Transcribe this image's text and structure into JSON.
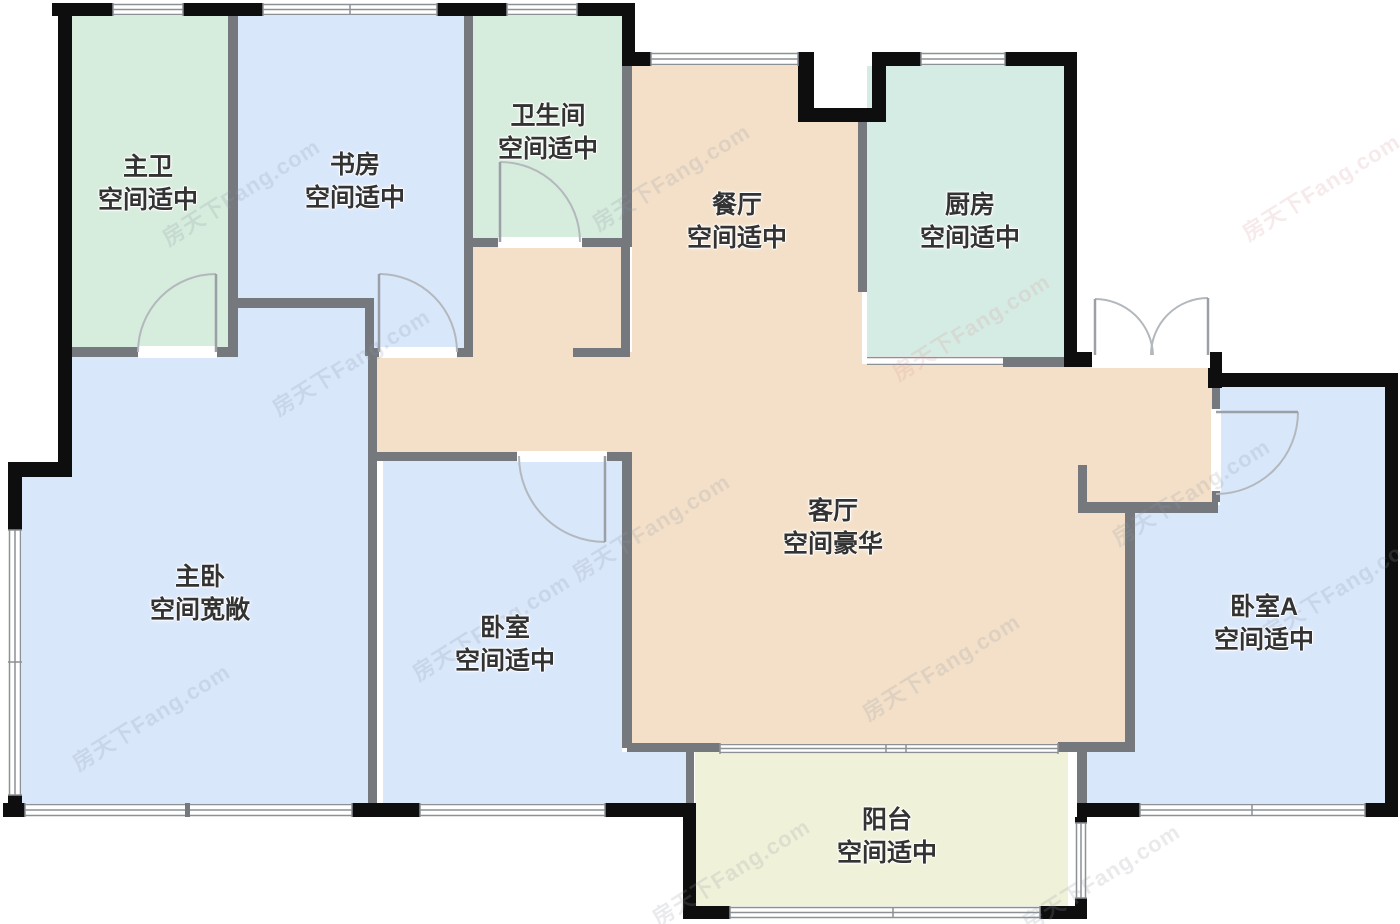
{
  "watermark": {
    "text": "房天下Fang.com",
    "gray_color": "#8f98a6",
    "pink_color": "#d89a9a"
  },
  "plan": {
    "background": "#ffffff",
    "wall_color": "#0e0e0e",
    "interior_wall_color": "#75797e",
    "window_line_color": "#8c9196",
    "door_color": "#9aa0a6",
    "arc_color": "#b3b8bd",
    "rooms": [
      {
        "id": "master-bath",
        "name": "主卫",
        "desc": "空间适中",
        "color": "#d6ecdc"
      },
      {
        "id": "study",
        "name": "书房",
        "desc": "空间适中",
        "color": "#d9e7fb"
      },
      {
        "id": "bathroom",
        "name": "卫生间",
        "desc": "空间适中",
        "color": "#d6ecdc"
      },
      {
        "id": "dining-room",
        "name": "餐厅",
        "desc": "空间适中",
        "color": "#f4e0c8"
      },
      {
        "id": "kitchen",
        "name": "厨房",
        "desc": "空间适中",
        "color": "#d5ece4"
      },
      {
        "id": "master-bedroom",
        "name": "主卧",
        "desc": "空间宽敞",
        "color": "#d9e7fb"
      },
      {
        "id": "bedroom",
        "name": "卧室",
        "desc": "空间适中",
        "color": "#d9e7fb"
      },
      {
        "id": "living-room",
        "name": "客厅",
        "desc": "空间豪华",
        "color": "#f4e0c8"
      },
      {
        "id": "bedroom-a",
        "name": "卧室A",
        "desc": "空间适中",
        "color": "#d9e7fb"
      },
      {
        "id": "balcony",
        "name": "阳台",
        "desc": "空间适中",
        "color": "#f0f1d9"
      }
    ]
  }
}
